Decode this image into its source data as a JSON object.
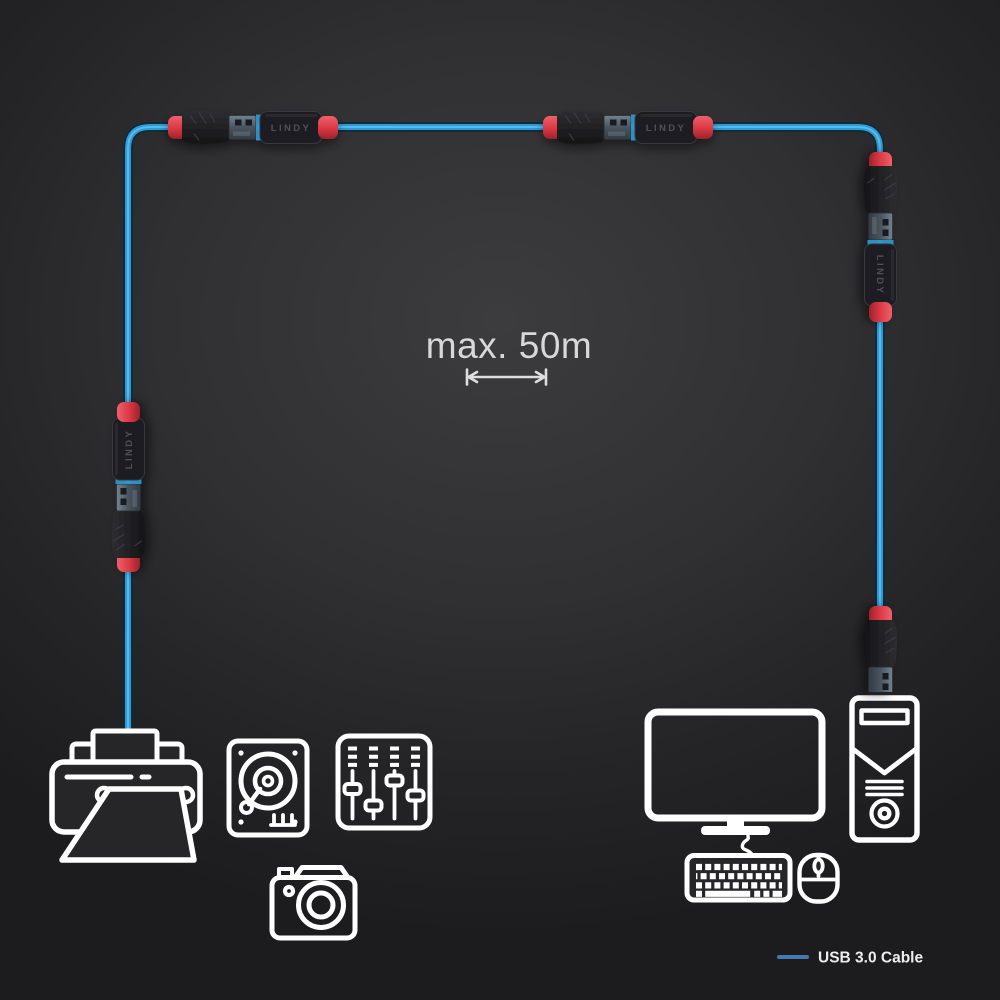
{
  "diagram": {
    "annotation": {
      "max_length": "max. 50m"
    },
    "legend": {
      "label": "USB 3.0 Cable"
    },
    "brand": "LINDY",
    "colors": {
      "bg_center": "#3c3c3e",
      "bg_edge": "#1c1c1e",
      "cable_blue": "#2f9ad3",
      "cable_core": "#5ec1ec",
      "cable_outline": "#0d2a3f",
      "connector_red": "#d93843",
      "icon_stroke": "#ffffff",
      "label_text": "#d8d8d8",
      "legend_line": "#4479b2"
    },
    "connectors": [
      {
        "name": "connector-pair-top-left",
        "label": "LINDY"
      },
      {
        "name": "connector-pair-top-right",
        "label": "LINDY"
      },
      {
        "name": "connector-pair-right",
        "label": "LINDY"
      },
      {
        "name": "connector-pair-left",
        "label": "LINDY"
      },
      {
        "name": "usb-plug-to-pc",
        "label": ""
      }
    ],
    "devices_left": [
      "printer",
      "hard-drive",
      "audio-mixer",
      "camera"
    ],
    "devices_right": [
      "monitor",
      "pc-tower",
      "keyboard",
      "mouse"
    ]
  }
}
